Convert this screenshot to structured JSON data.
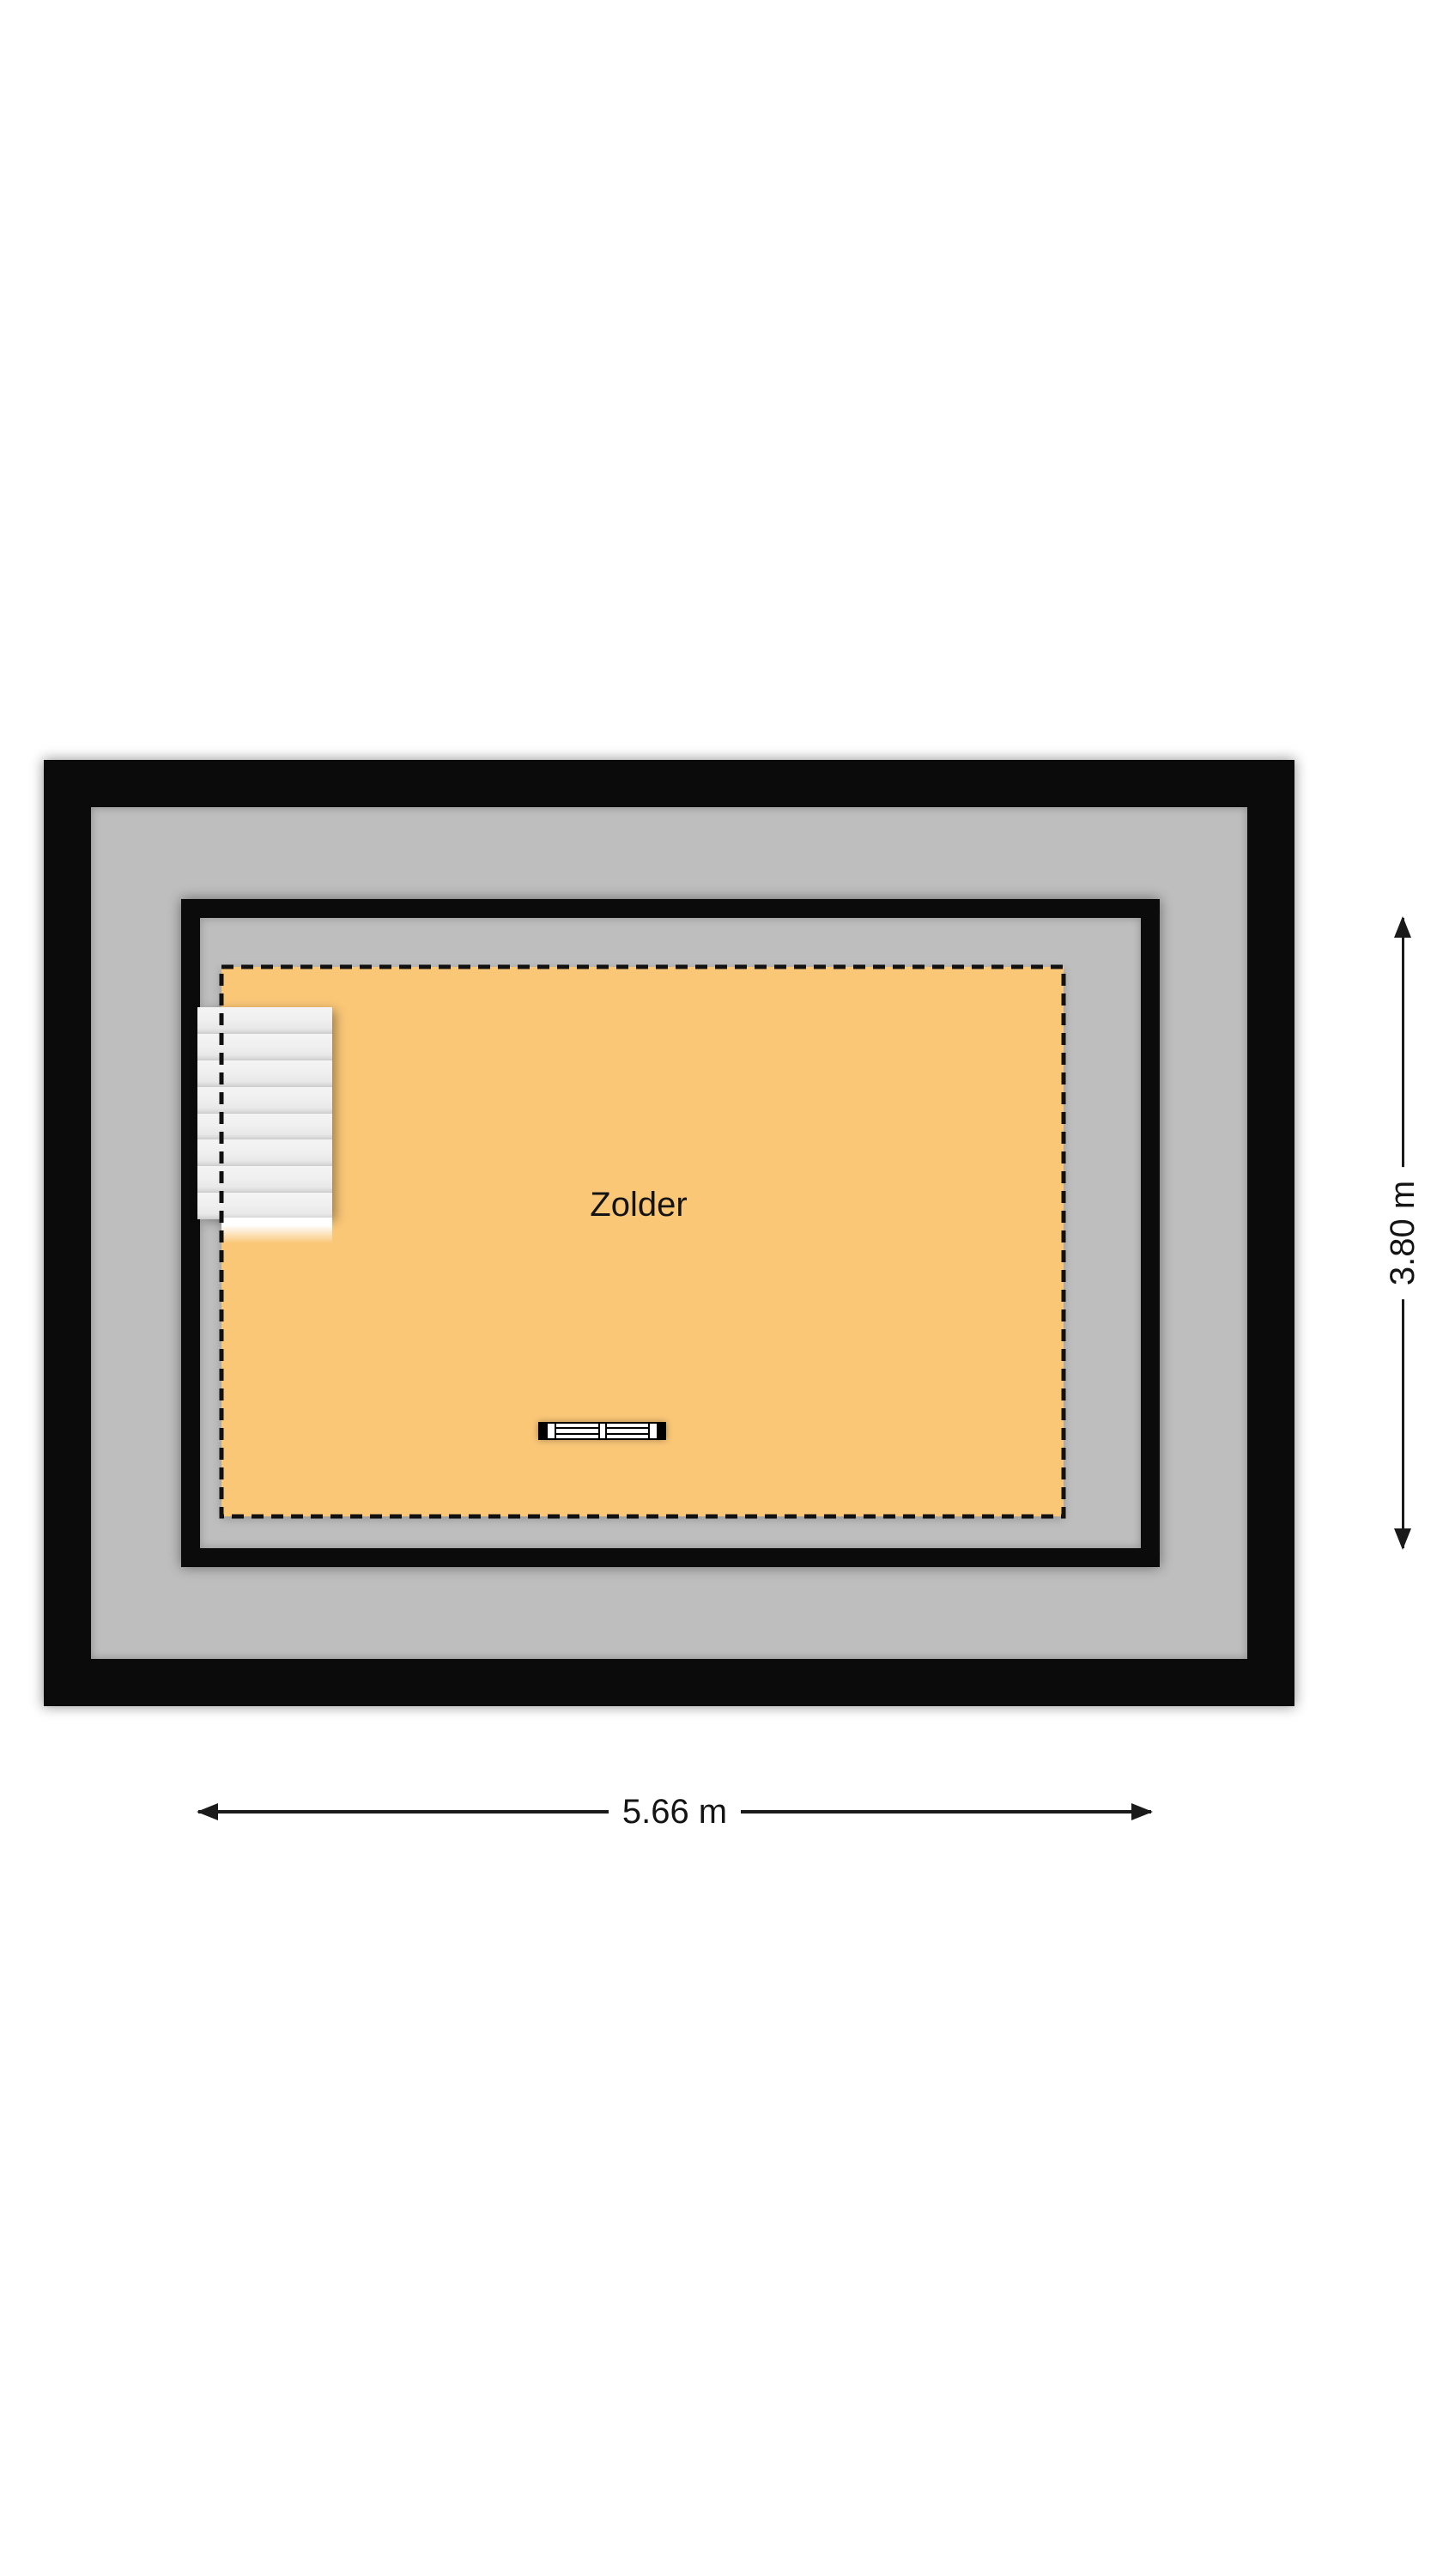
{
  "floorplan": {
    "room": {
      "label": "Zolder"
    },
    "dimensions": {
      "width": "5.66 m",
      "height": "3.80 m"
    },
    "colors": {
      "wall": "#0b0b0b",
      "surround_floor": "#bebebe",
      "attic_floor": "#fac777",
      "stairs": "#efefef",
      "dashed_boundary": "#111111",
      "dimension_line": "#1a1a1a",
      "background": "#ffffff"
    },
    "icons": {
      "stairs": "stairs-icon",
      "radiator": "radiator-icon",
      "dimension_arrows": "arrow-icon"
    }
  }
}
